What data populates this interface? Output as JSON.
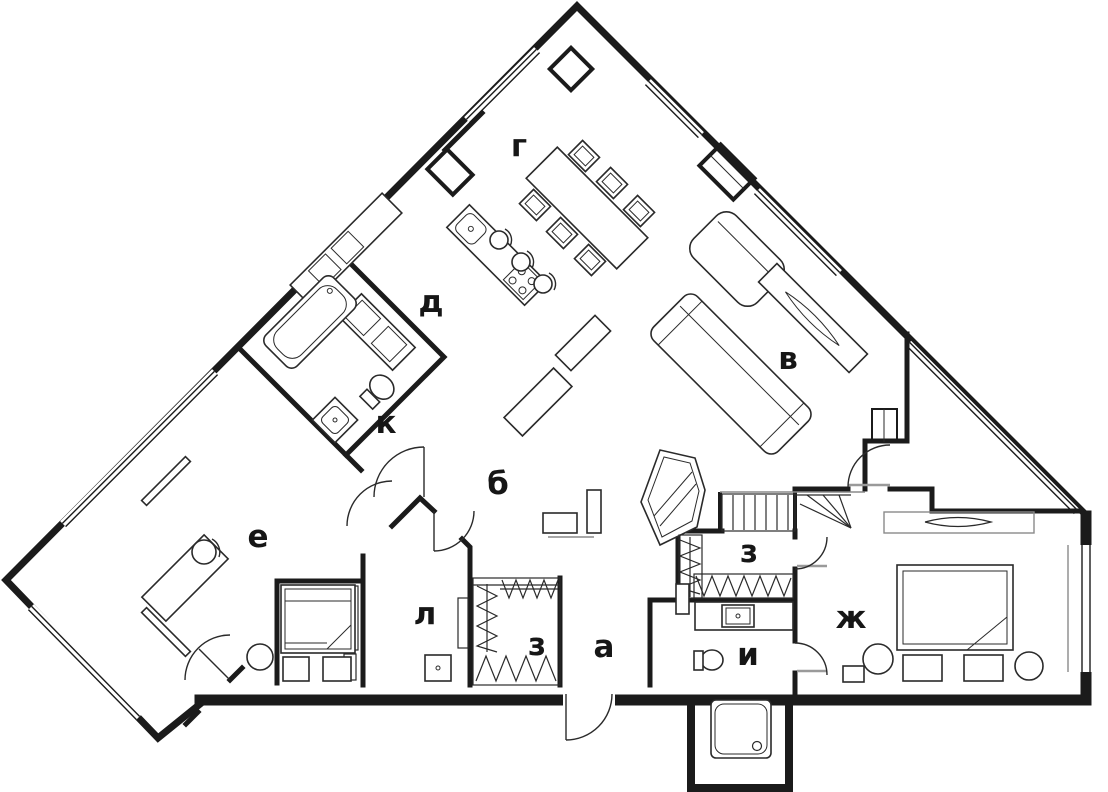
{
  "plan": {
    "background": "#ffffff",
    "ink_color": "#1b1b1b",
    "muted_color": "#9a9a9a",
    "rooms": [
      {
        "label": "г",
        "x": 519,
        "y": 156
      },
      {
        "label": "д",
        "x": 431,
        "y": 312
      },
      {
        "label": "в",
        "x": 788,
        "y": 369
      },
      {
        "label": "к",
        "x": 386,
        "y": 433
      },
      {
        "label": "б",
        "x": 498,
        "y": 494
      },
      {
        "label": "е",
        "x": 258,
        "y": 547
      },
      {
        "label": "л",
        "x": 425,
        "y": 624
      },
      {
        "label": "з",
        "x": 537,
        "y": 655
      },
      {
        "label": "а",
        "x": 604,
        "y": 657
      },
      {
        "label": "з",
        "x": 749,
        "y": 562
      },
      {
        "label": "ж",
        "x": 851,
        "y": 628
      },
      {
        "label": "и",
        "x": 748,
        "y": 665
      }
    ]
  }
}
